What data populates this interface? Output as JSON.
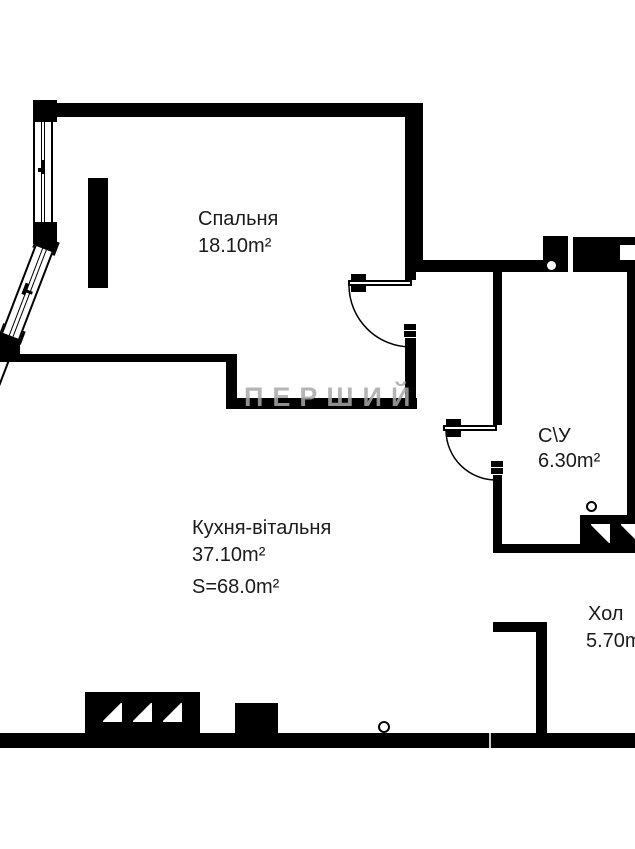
{
  "plan": {
    "watermark": "ПЕРШИЙ",
    "rooms": [
      {
        "id": "bedroom",
        "name": "Спальня",
        "area": "18.10m²"
      },
      {
        "id": "kitchen",
        "name": "Кухня-вітальня",
        "area": "37.10m²",
        "total": "S=68.0m²"
      },
      {
        "id": "bathroom",
        "name": "С\\У",
        "area": "6.30m²"
      },
      {
        "id": "hall",
        "name": "Хол",
        "area": "5.70m²"
      }
    ],
    "colors": {
      "wall": "#000000",
      "background": "#ffffff",
      "text": "#1b1b1b",
      "watermark": "#a9a9a9"
    }
  }
}
